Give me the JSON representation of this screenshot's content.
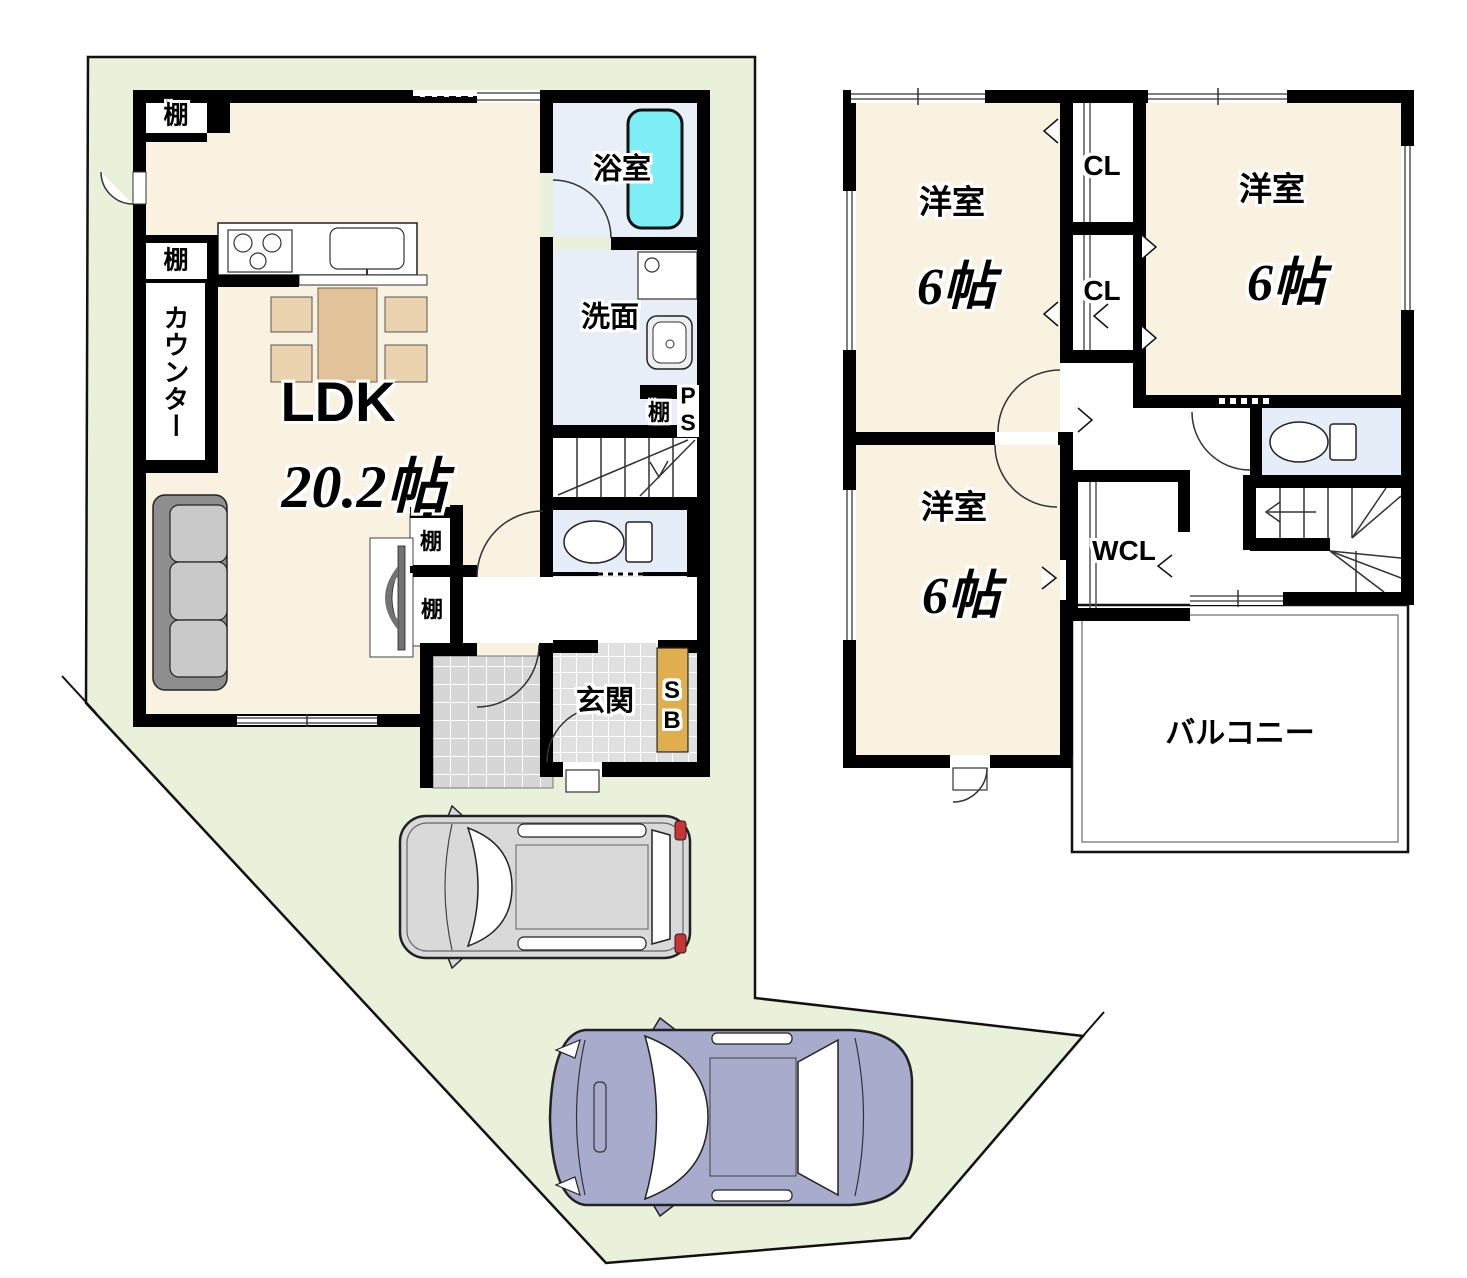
{
  "document_type": "floor-plan",
  "colors": {
    "lot_fill": "#eaf1da",
    "lot_line": "#111111",
    "wall": "#000000",
    "room_cream": "#faf2e1",
    "bath_blue": "#e9eff8",
    "wash_blue": "#e7eef7",
    "toilet_blue": "#e4edf8",
    "tub_cyan": "#7deef6",
    "tile_porch": "#d6d6d6",
    "tile_entrance": "#e0e0e0",
    "shoe_box": "#dfae4e",
    "table_tan": "#e2c298",
    "chair_tan": "#ead3ae",
    "sofa_seat": "#c9c9c9",
    "sofa_back": "#8e8e8e",
    "tv_gray": "#737373",
    "car_minivan": "#d9d9d9",
    "car_sedan": "#a9abcc",
    "taillight_red": "#cc3333"
  },
  "floor1": {
    "labels": {
      "shelf_top": "棚",
      "bath": "浴室",
      "shelf_mid": "棚",
      "counter": "カウンター",
      "washroom": "洗面",
      "shelf_small": "棚",
      "ps_line1": "P",
      "ps_line2": "S",
      "ldk": "LDK",
      "ldk_size": "20.2帖",
      "tv_shelf_upper": "棚",
      "tv_shelf_lower": "棚",
      "entrance": "玄関",
      "shoebox_line1": "S",
      "shoebox_line2": "B"
    }
  },
  "floor2": {
    "labels": {
      "bedroom1": "洋室",
      "bedroom1_size": "6帖",
      "closet1": "CL",
      "closet2": "CL",
      "bedroom2": "洋室",
      "bedroom2_size": "6帖",
      "bedroom3": "洋室",
      "bedroom3_size": "6帖",
      "walk_in_closet": "WCL",
      "balcony": "バルコニー"
    }
  }
}
